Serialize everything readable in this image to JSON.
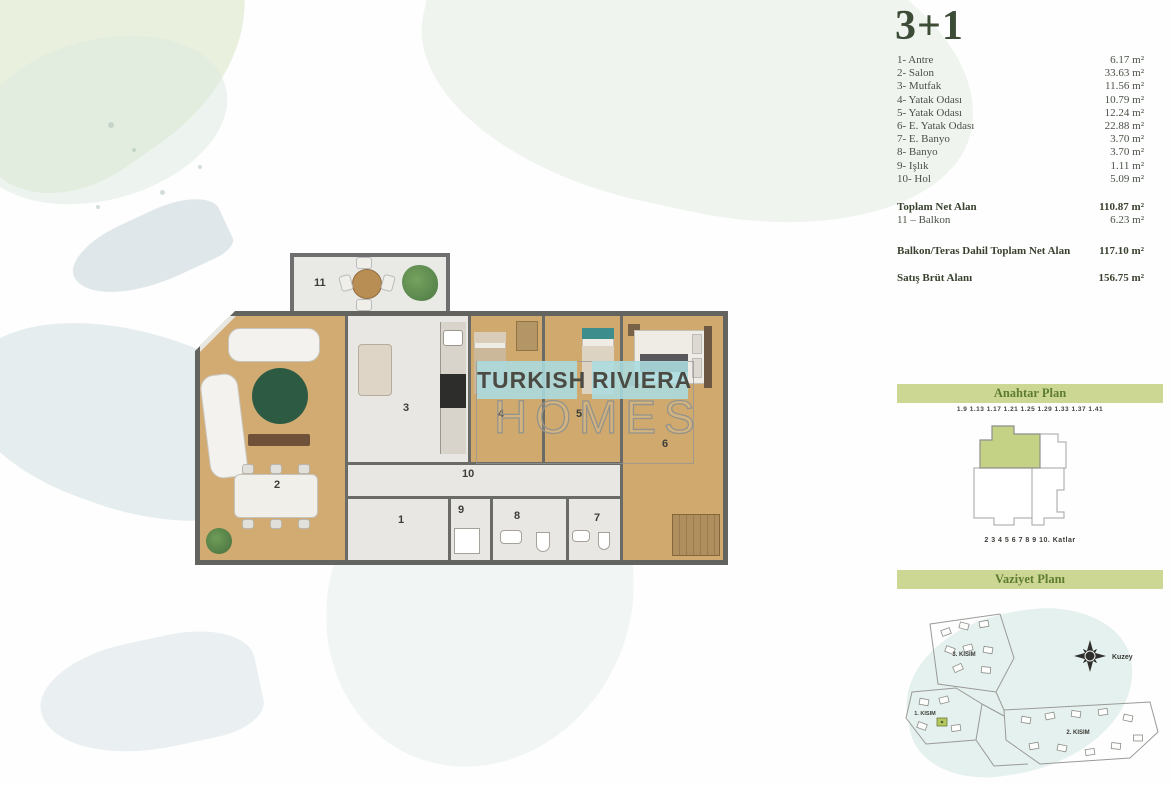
{
  "title": "3+1",
  "room_list": {
    "items": [
      {
        "label": "1- Antre",
        "area": "6.17 m²"
      },
      {
        "label": "2- Salon",
        "area": "33.63 m²"
      },
      {
        "label": "3- Mutfak",
        "area": "11.56 m²"
      },
      {
        "label": "4- Yatak Odası",
        "area": "10.79 m²"
      },
      {
        "label": "5- Yatak Odası",
        "area": "12.24 m²"
      },
      {
        "label": "6- E. Yatak Odası",
        "area": "22.88 m²"
      },
      {
        "label": "7- E. Banyo",
        "area": "3.70 m²"
      },
      {
        "label": "8- Banyo",
        "area": "3.70 m²"
      },
      {
        "label": "9- Işlık",
        "area": "1.11 m²"
      },
      {
        "label": "10- Hol",
        "area": "5.09 m²"
      }
    ]
  },
  "summary": {
    "toplam": {
      "label": "Toplam Net Alan",
      "value": "110.87 m²"
    },
    "balkon": {
      "label": "11 – Balkon",
      "value": "6.23 m²"
    },
    "dahil": {
      "label": "Balkon/Teras Dahil Toplam Net Alan",
      "value": "117.10 m²"
    },
    "brut": {
      "label": "Satış Brüt Alanı",
      "value": "156.75 m²"
    }
  },
  "watermark": {
    "word1": "TURKISH",
    "word2": "RIVIERA",
    "word3": "HOMES"
  },
  "key_plan": {
    "header": "Anahtar Plan",
    "units_line": "1.9  1.13  1.17  1.21  1.25  1.29  1.33  1.37  1.41",
    "floors_line": "2 3 4 5 6 7 8 9 10. Katlar"
  },
  "site_plan": {
    "header": "Vaziyet Planı",
    "labels": [
      "3. KISIM",
      "1. KISIM",
      "2. KISIM"
    ],
    "compass_label": "Kuzey"
  },
  "plan": {
    "numbers": [
      "1",
      "2",
      "3",
      "4",
      "5",
      "6",
      "7",
      "8",
      "9",
      "10",
      "11"
    ]
  },
  "colors": {
    "header_bar_bg": "#ccd794",
    "header_bar_text": "#5d7c2f",
    "title_text": "#3d4c36",
    "keyplan_highlight": "#c3d285",
    "watermark_bg": "#abdce0",
    "wood_floor": "#d1ab71",
    "wall": "#636360"
  }
}
